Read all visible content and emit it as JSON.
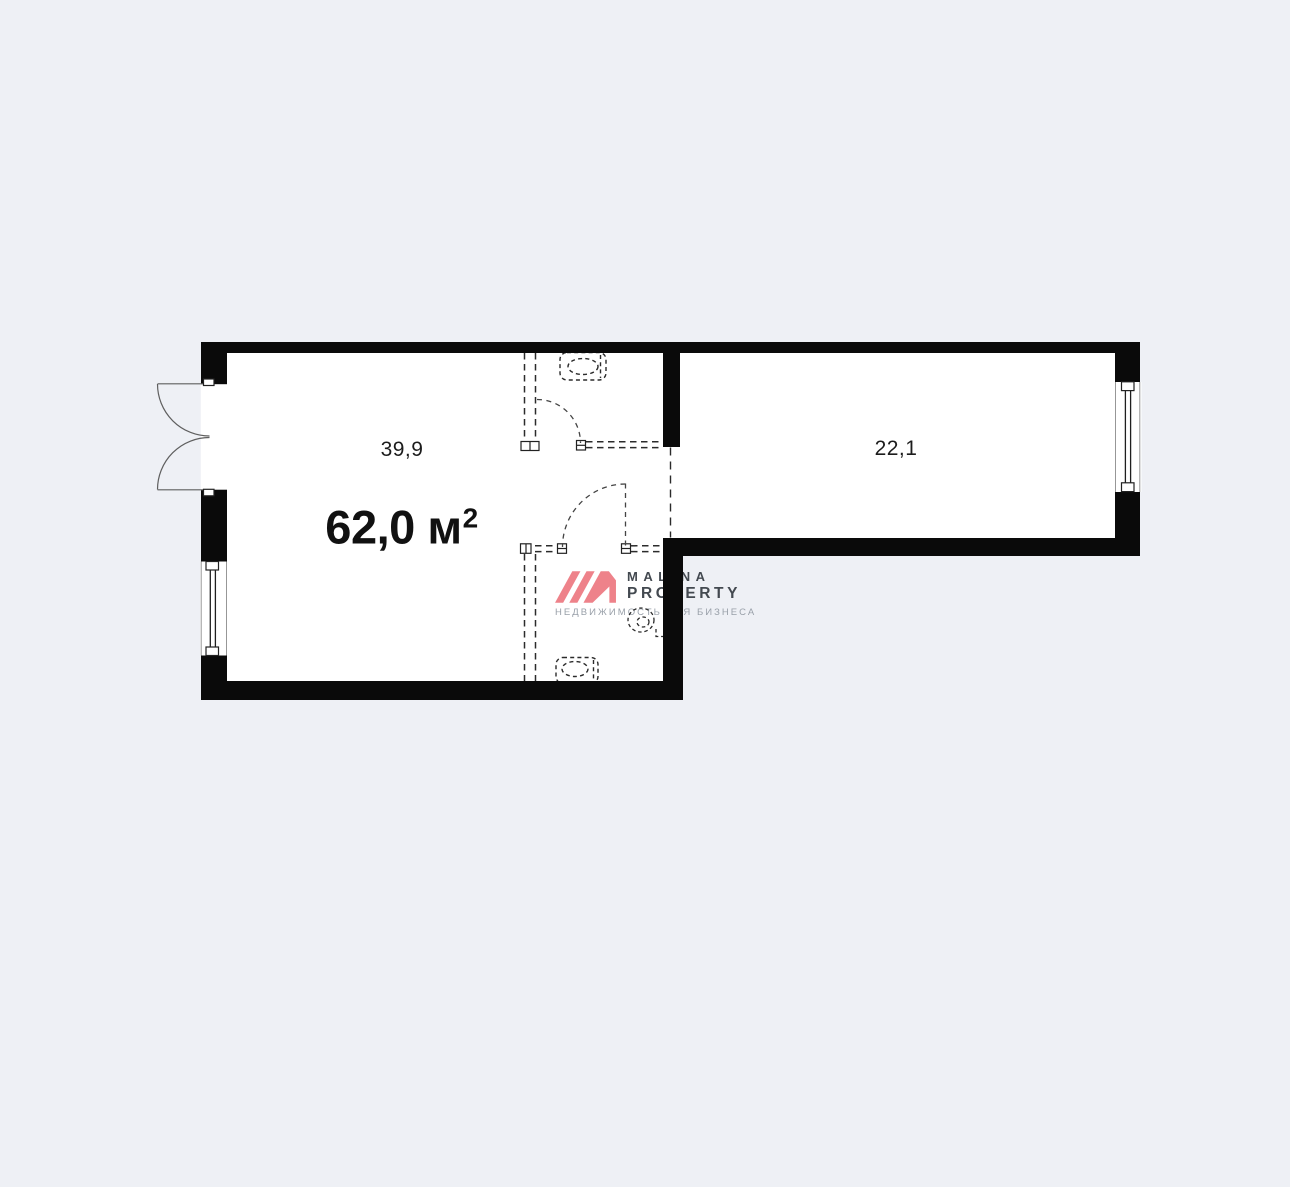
{
  "page": {
    "background_color": "#eef0f5"
  },
  "floorplan": {
    "wall_color": "#0a0a0a",
    "floor_color": "#ffffff",
    "line_color": "#2b2b2b",
    "total_area": {
      "value": "62,0 м",
      "superscript": "2"
    },
    "rooms": [
      {
        "id": "room-left",
        "area_label": "39,9"
      },
      {
        "id": "room-right",
        "area_label": "22,1"
      }
    ],
    "fixtures": [
      "toilet-icon-top",
      "toilet-icon-bottom",
      "sink-icon"
    ],
    "openings": [
      "entrance-double-door",
      "window-left",
      "window-right",
      "interior-door-top",
      "interior-door-bottom",
      "room-passage"
    ]
  },
  "watermark": {
    "brand_line1": "MALINA",
    "brand_line2": "PROPERTY",
    "tagline": "НЕДВИЖИМОСТЬ ДЛЯ БИЗНЕСА",
    "accent_color": "#ee828a",
    "text_color": "#434950",
    "tagline_color": "#99a0a9"
  }
}
